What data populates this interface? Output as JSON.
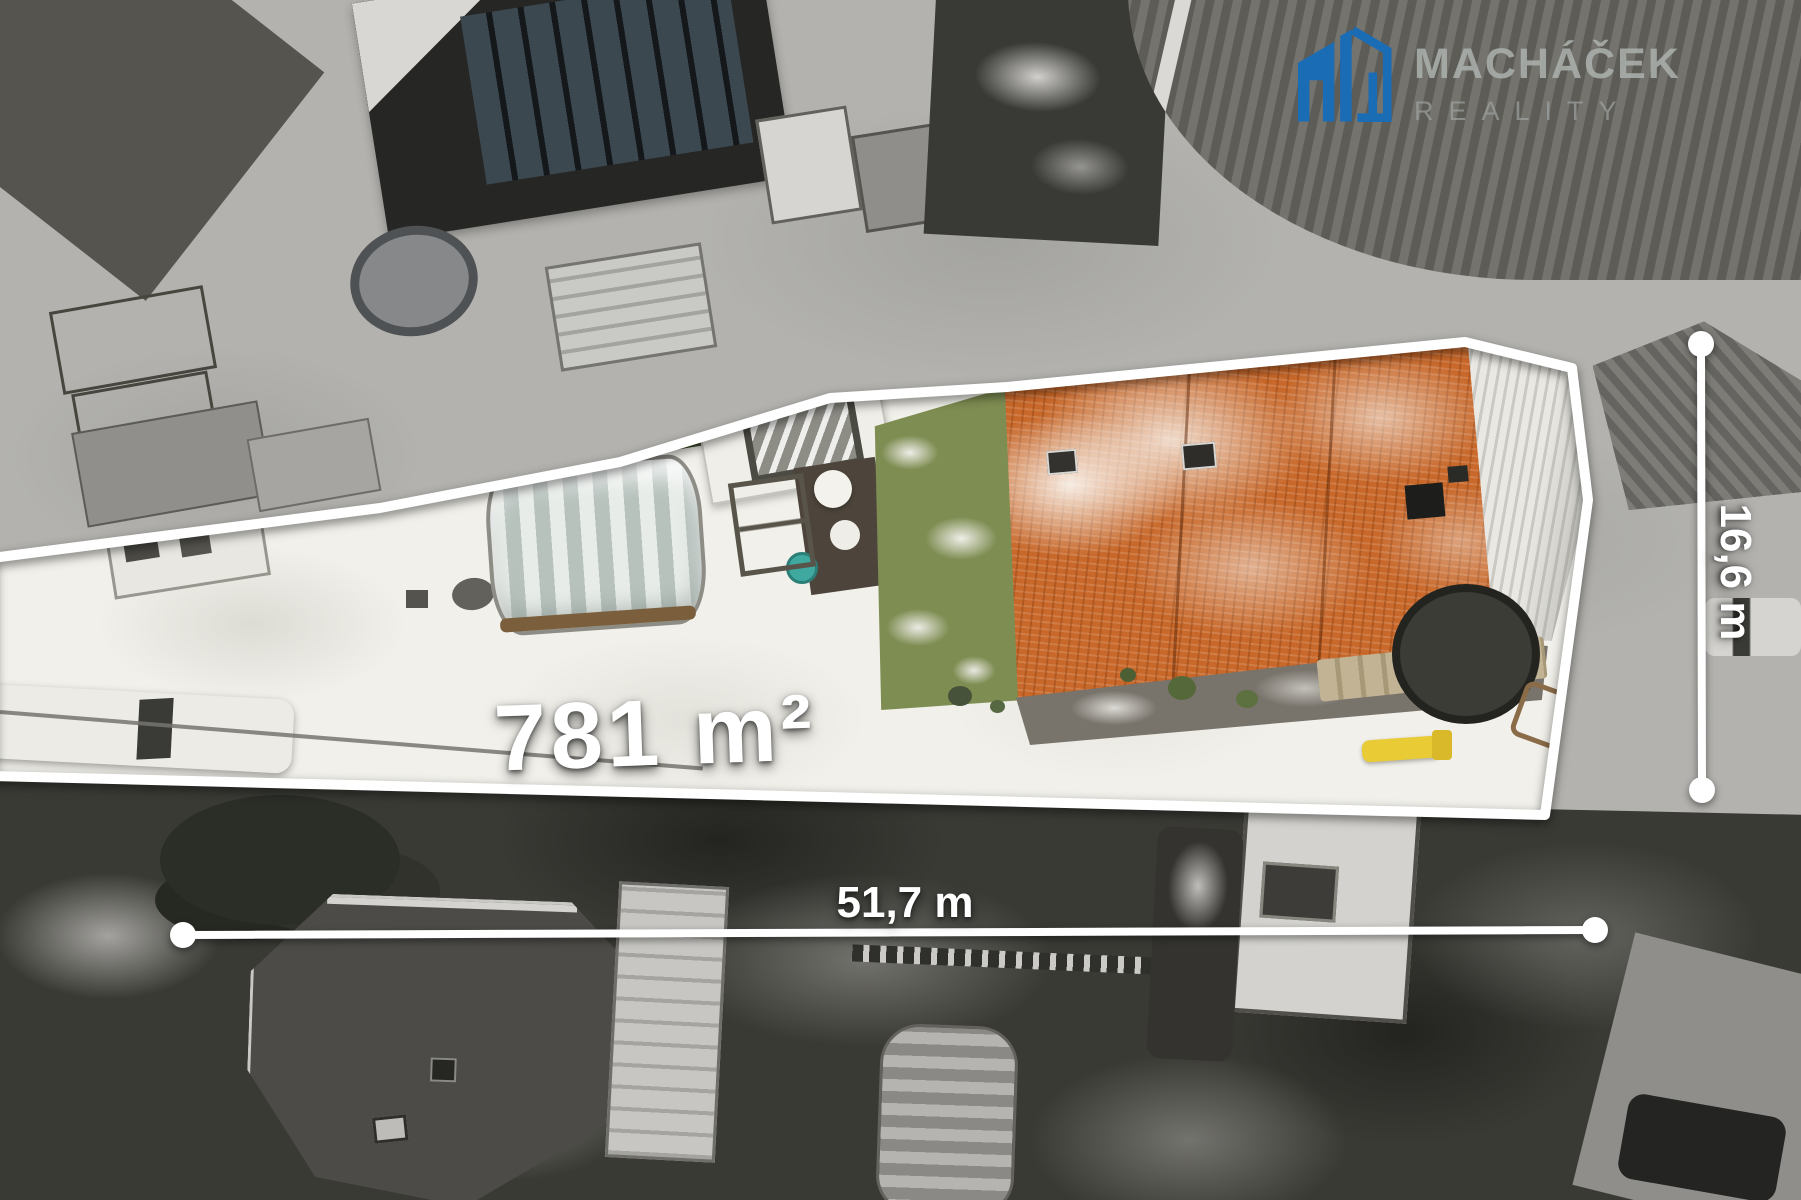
{
  "watermark": {
    "brand_name": "MACHÁČEK",
    "brand_sub": "REALITY",
    "icon": "house-logo-icon",
    "brand_color": "#1a6cb5",
    "text_color": "#a7acaa"
  },
  "annotations": {
    "area_label": "781 m²",
    "width_label": "51,7 m",
    "depth_label": "16,6 m",
    "outline_color": "#ffffff"
  },
  "palette": {
    "roof_orange": "#c8682a",
    "snow_inside": "#f1f0ea",
    "snow_outside": "#b3b2ae",
    "trees_dark": "#3a3a35",
    "grass_green": "#7e8d52"
  }
}
